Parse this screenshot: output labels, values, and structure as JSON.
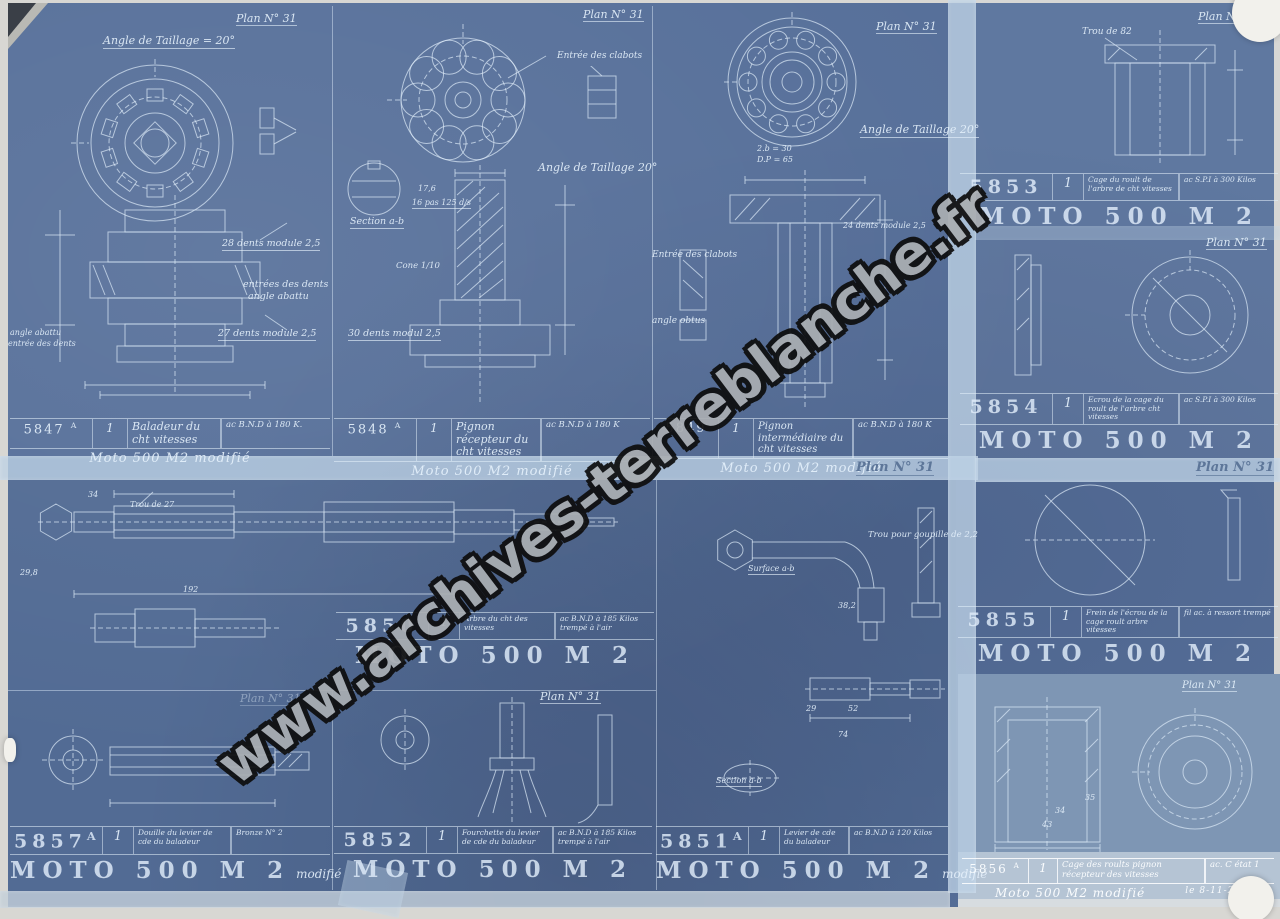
{
  "sheet": {
    "watermark": "www.archives-terreblanche.fr"
  },
  "panels": {
    "p5847": {
      "plan": "Plan N° 31",
      "ann": {
        "taillage": "Angle de Taillage = 20°",
        "dents28": "28 dents module 2,5",
        "entrees": "entrées des dents",
        "abattu": "angle abattu",
        "dents27": "27 dents module 2,5",
        "abattu2": "angle abattu",
        "entree2": "entrée des dents"
      },
      "num": "5847",
      "sup": "A",
      "qty": "1",
      "desc": "Baladeur du cht vitesses",
      "mat": "ac B.N.D à 180 K.",
      "footer": "Moto 500 M2 modifié"
    },
    "p5848": {
      "plan": "Plan N° 31",
      "ann": {
        "clabots": "Entrée des clabots",
        "taillage": "Angle de Taillage 20°",
        "d176": "17,6",
        "pas": "16 pas 125 d/s",
        "section": "Section a-b",
        "cone": "Cone 1/10",
        "dents30": "30 dents modul 2,5"
      },
      "num": "5848",
      "sup": "A",
      "qty": "1",
      "desc": "Pignon récepteur du cht vitesses",
      "mat": "ac B.N.D à 180 K",
      "footer": "Moto 500 M2 modifié"
    },
    "p5849": {
      "plan": "Plan N° 31",
      "ann": {
        "taillage": "Angle de Taillage 20°",
        "b30": "2.b = 30",
        "dp": "D.P = 65",
        "dents24": "24 dents module 2,5",
        "clabots": "Entrée des clabots",
        "obtus": "angle obtus"
      },
      "num": "5849",
      "qty": "1",
      "desc": "Pignon intermédiaire du cht vitesses",
      "mat": "ac B.N.D à 180 K",
      "footer": "Moto 500 M2 modifié"
    },
    "p5853": {
      "plan": "Plan N° 31",
      "ann": {
        "trou": "Trou de 82"
      },
      "num": "5853",
      "qty": "1",
      "desc": "Cage du roult de l'arbre de cht vitesses",
      "mat": "ac S.P.I à 300 Kilos",
      "footer": "MOTO 500 M 2"
    },
    "p5854": {
      "plan": "Plan N° 31",
      "num": "5854",
      "qty": "1",
      "desc": "Ecrou de la cage du roult de l'arbre cht vitesses",
      "mat": "ac S.P.I à 300 Kilos",
      "footer": "MOTO 500 M 2"
    },
    "p5855": {
      "plan": "Plan N° 31",
      "num": "5855",
      "qty": "1",
      "desc": "Frein de l'écrou de la cage roult arbre vitesses",
      "mat": "fil ac. à ressort trempé",
      "footer": "MOTO 500 M 2"
    },
    "p5850": {
      "ann": {
        "d34": "34",
        "trou27": "Trou de 27",
        "d298": "29,8",
        "d192": "192"
      },
      "num": "5850",
      "qty": "1",
      "desc": "Arbre du cht des vitesses",
      "mat": "ac B.N.D à 185 Kilos trempé à l'air",
      "footer": "MOTO 500 M 2"
    },
    "p5851": {
      "plan": "Plan N° 31",
      "ann": {
        "goupille": "Trou pour goupille de 2,2",
        "surface": "Surface a-b",
        "d382": "38,2",
        "d29": "29",
        "d52": "52",
        "d74": "74",
        "section": "Section a-b"
      },
      "num": "5851",
      "sup": "A",
      "qty": "1",
      "desc": "Levier de cde du baladeur",
      "mat": "ac B.N.D à 120 Kilos",
      "footer": "MOTO 500 M 2",
      "mod": "modifié"
    },
    "p5852": {
      "plan": "Plan N° 31",
      "num": "5852",
      "qty": "1",
      "desc": "Fourchette du levier de cde du baladeur",
      "mat": "ac B.N.D à 185 Kilos trempé à l'air",
      "footer": "MOTO 500 M 2"
    },
    "p5857": {
      "plan": "Plan N° 31",
      "num": "5857",
      "sup": "A",
      "qty": "1",
      "desc": "Douille du levier de cde du baladeur",
      "mat": "Bronze N° 2",
      "footer": "MOTO 500 M 2",
      "mod": "modifié"
    },
    "p5856": {
      "plan": "Plan N° 31",
      "ann": {
        "d34": "34",
        "d43": "43",
        "d35": "35"
      },
      "num": "5856",
      "sup": "A",
      "qty": "1",
      "desc": "Cage des roults pignon récepteur des vitesses",
      "mat": "ac. C état 1",
      "footer": "Moto 500 M2 modifié",
      "date": "le 8-11-26"
    }
  }
}
